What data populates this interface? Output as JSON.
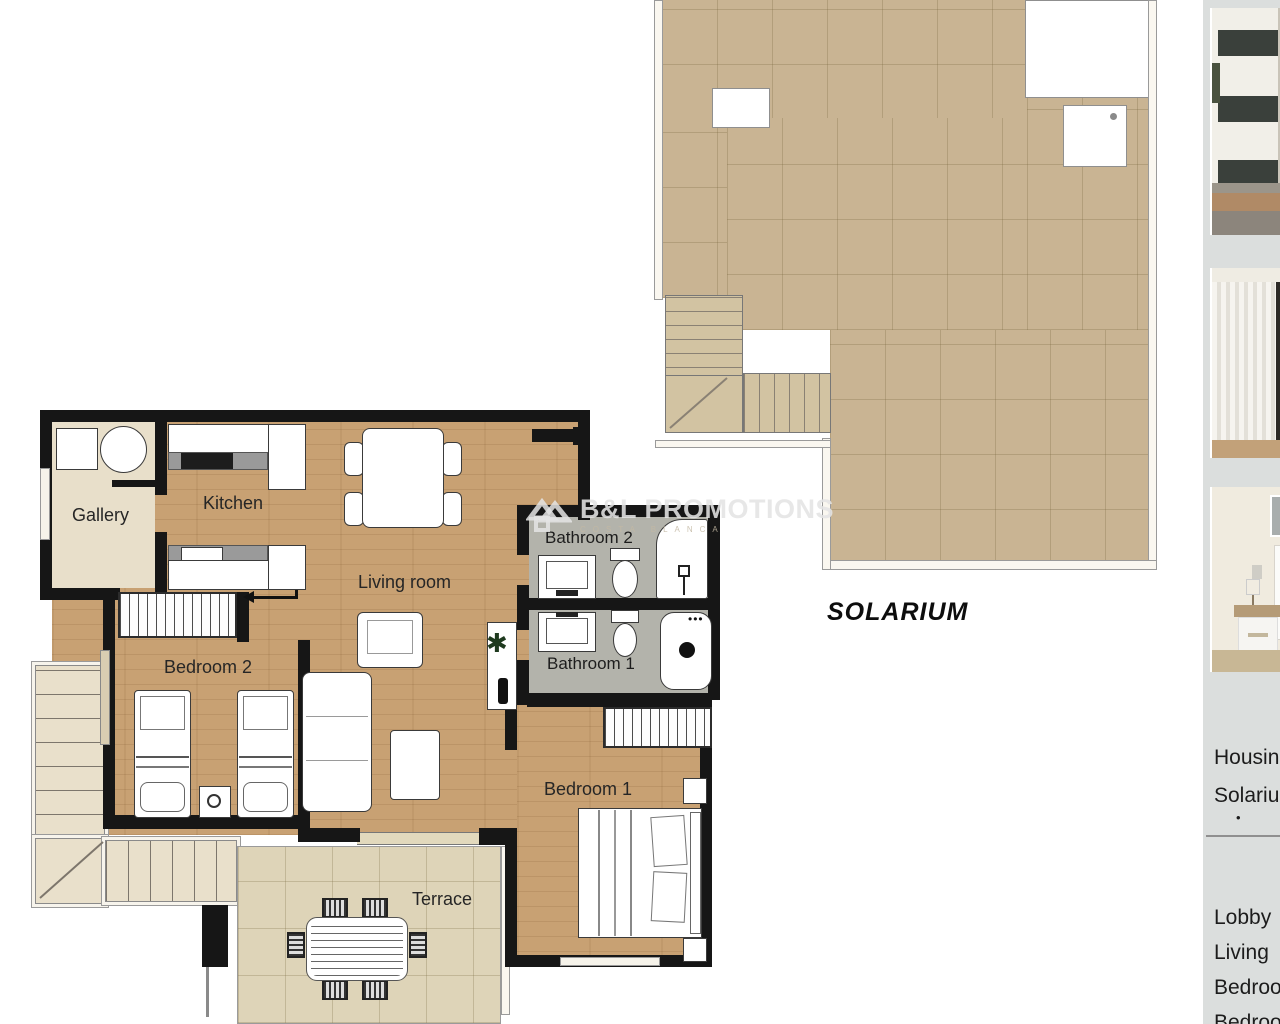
{
  "watermark": {
    "brand": "B&L PROMOTIONS",
    "tagline": "COSTA BLANCA"
  },
  "floorplan": {
    "rooms": [
      {
        "id": "gallery",
        "label": "Gallery"
      },
      {
        "id": "kitchen",
        "label": "Kitchen"
      },
      {
        "id": "living-room",
        "label": "Living room"
      },
      {
        "id": "bedroom-2",
        "label": "Bedroom 2"
      },
      {
        "id": "bathroom-2",
        "label": "Bathroom 2"
      },
      {
        "id": "bathroom-1",
        "label": "Bathroom 1"
      },
      {
        "id": "bedroom-1",
        "label": "Bedroom 1"
      },
      {
        "id": "terrace",
        "label": "Terrace"
      },
      {
        "id": "solarium",
        "label": "SOLARIUM"
      }
    ]
  },
  "sidebar": {
    "photos": [
      {
        "name": "building-exterior-render"
      },
      {
        "name": "interior-window-curtains"
      },
      {
        "name": "bedroom-furniture"
      }
    ],
    "list_top": [
      {
        "label": "Housing"
      },
      {
        "label": "Solarium"
      }
    ],
    "bullet": "•",
    "list_bottom": [
      {
        "label": "Lobby"
      },
      {
        "label": "Living"
      },
      {
        "label": "Bedroom"
      },
      {
        "label": "Bedroom"
      }
    ]
  },
  "colors": {
    "wall": "#161616",
    "wood_floor": "#c8a173",
    "solarium_tile": "#c9b493",
    "terrace_tile": "#ded4b8",
    "bathroom_floor": "#b3b3ab",
    "gallery_floor": "#e8dfca",
    "sidebar_bg": "#dbdedd"
  }
}
